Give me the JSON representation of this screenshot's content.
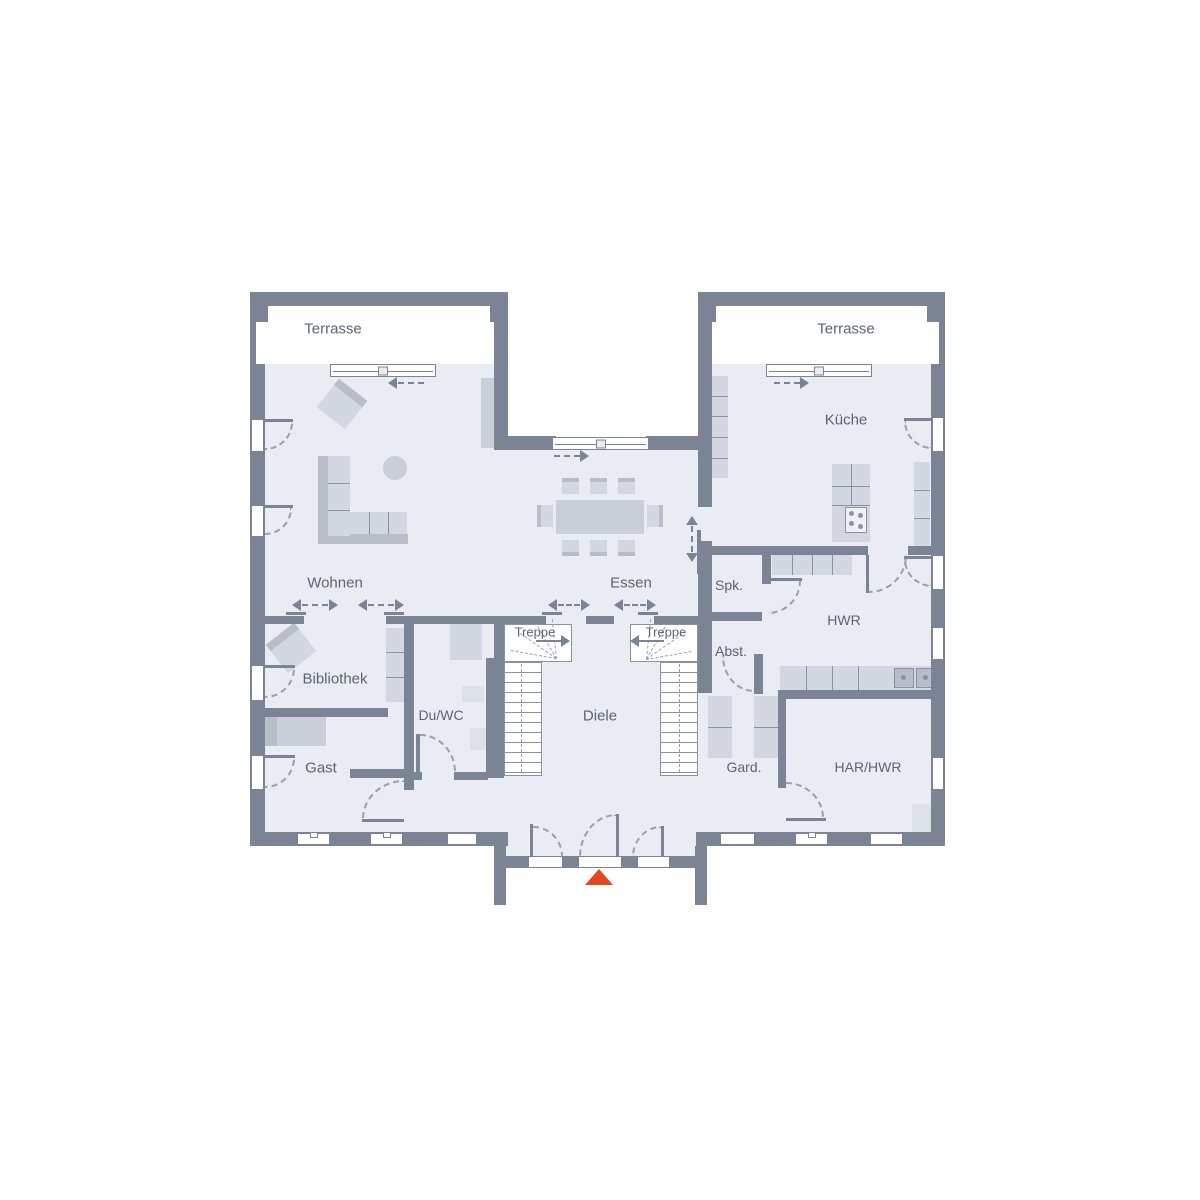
{
  "rooms": {
    "terrace_left": "Terrasse",
    "terrace_right": "Terrasse",
    "living": "Wohnen",
    "dining": "Essen",
    "kitchen": "Küche",
    "pantry": "Spk.",
    "utility": "HWR",
    "storage": "Abst.",
    "library": "Bibliothek",
    "shower_wc": "Du/WC",
    "stair_left": "Treppe",
    "stair_right": "Treppe",
    "hall": "Diele",
    "guest": "Gast",
    "wardrobe": "Gard.",
    "tech_room": "HAR/HWR"
  },
  "colors": {
    "wall": "#7b8494",
    "floor": "#e9ecf2",
    "furniture": "#d2d7e1",
    "furnitureDark": "#b7bdc9",
    "furnitureMid": "#c9cfd9",
    "furnitureLight": "#dde1e8",
    "outline": "#8a92a2",
    "dash": "#98a0ae",
    "text": "#5b6474",
    "accent": "#e2471d",
    "white": "#ffffff"
  }
}
